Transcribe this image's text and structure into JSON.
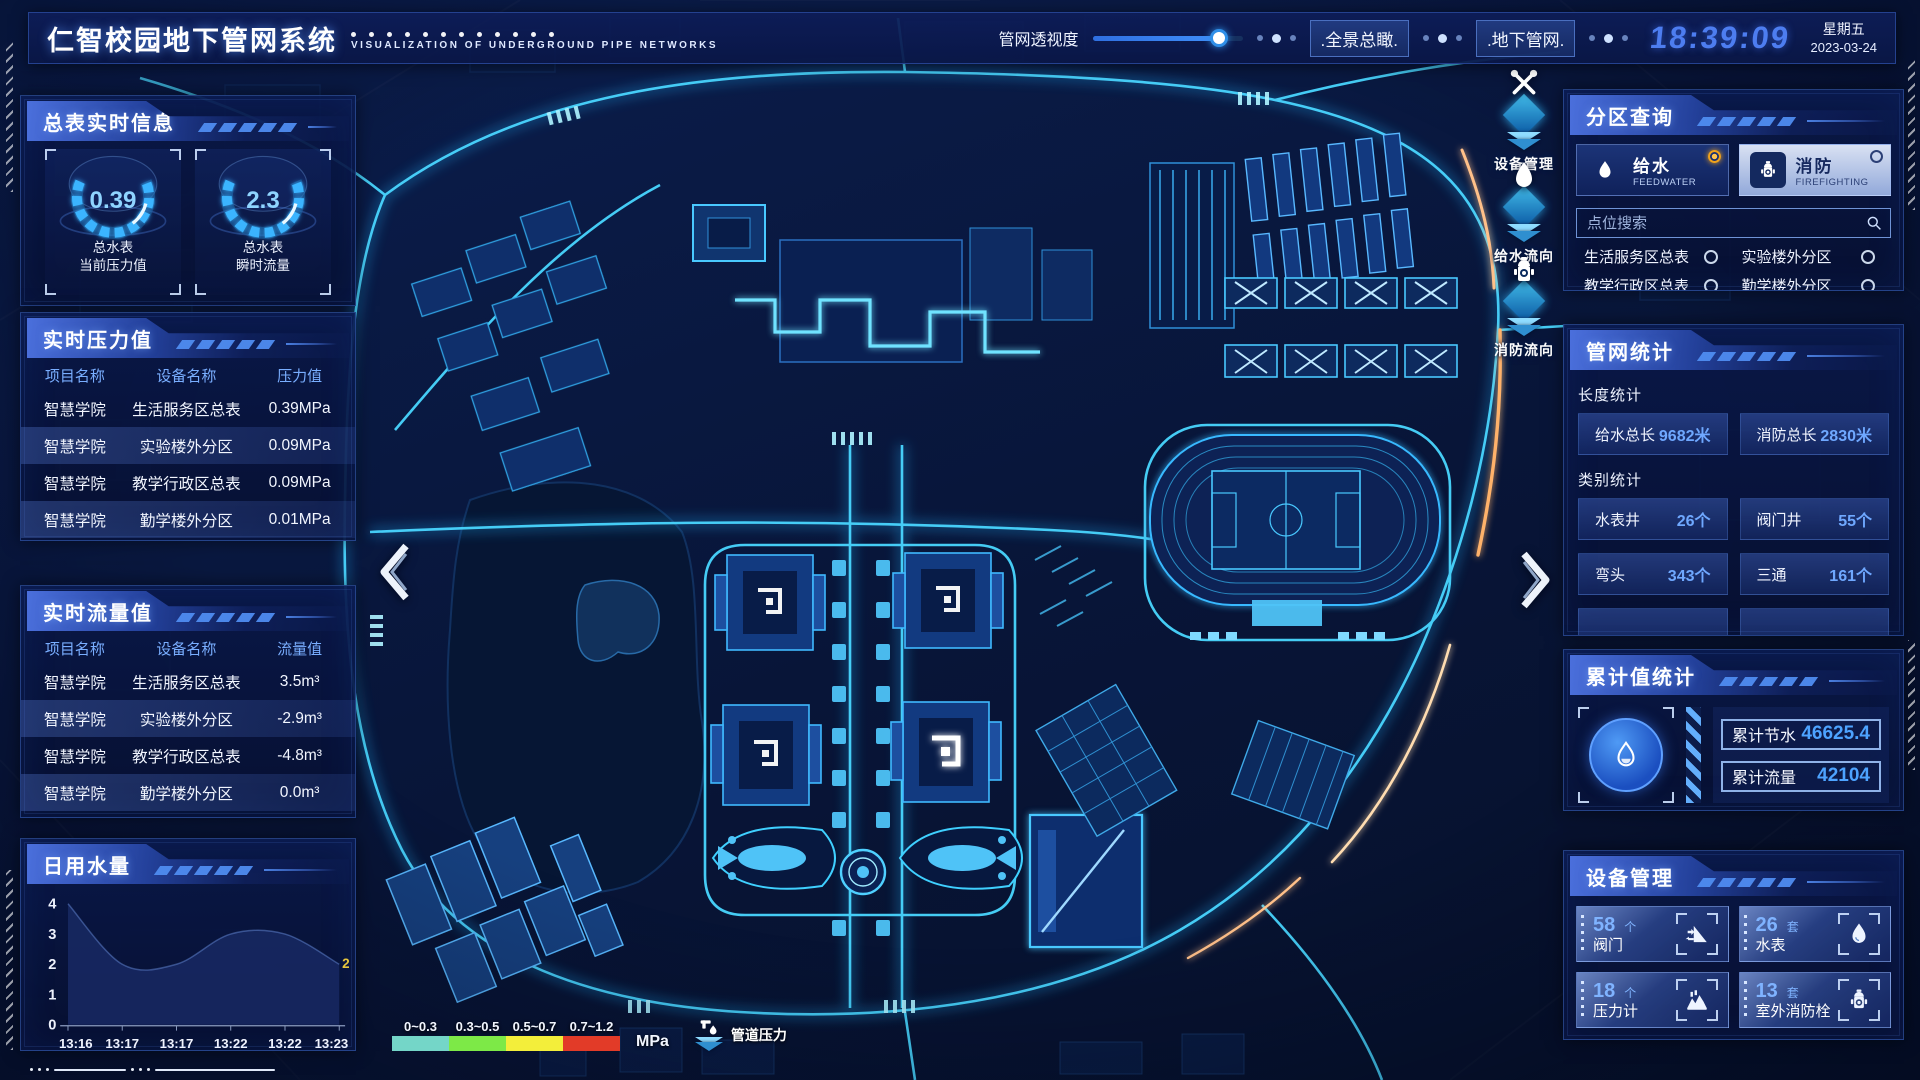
{
  "header": {
    "title": "仁智校园地下管网系统",
    "subtitle": "VISUALIZATION OF UNDERGROUND PIPE NETWORKS",
    "transparency_label": "管网透视度",
    "overview_btn": ".全景总瞰.",
    "underground_btn": ".地下管网.",
    "time": "18:39:09",
    "weekday": "星期五",
    "date": "2023-03-24"
  },
  "left": {
    "meters": {
      "title": "总表实时信息",
      "gauges": [
        {
          "value": "0.39",
          "line1": "总水表",
          "line2": "当前压力值"
        },
        {
          "value": "2.3",
          "line1": "总水表",
          "line2": "瞬时流量"
        }
      ]
    },
    "pressure": {
      "title": "实时压力值",
      "headers": [
        "项目名称",
        "设备名称",
        "压力值"
      ],
      "rows": [
        [
          "智慧学院",
          "生活服务区总表",
          "0.39MPa"
        ],
        [
          "智慧学院",
          "实验楼外分区",
          "0.09MPa"
        ],
        [
          "智慧学院",
          "教学行政区总表",
          "0.09MPa"
        ],
        [
          "智慧学院",
          "勤学楼外分区",
          "0.01MPa"
        ],
        [
          "智慧学院",
          "砺学楼外分区",
          "0.09MPa"
        ]
      ]
    },
    "flow": {
      "title": "实时流量值",
      "headers": [
        "项目名称",
        "设备名称",
        "流量值"
      ],
      "rows": [
        [
          "智慧学院",
          "生活服务区总表",
          "3.5m³"
        ],
        [
          "智慧学院",
          "实验楼外分区",
          "-2.9m³"
        ],
        [
          "智慧学院",
          "教学行政区总表",
          "-4.8m³"
        ],
        [
          "智慧学院",
          "勤学楼外分区",
          "0.0m³"
        ],
        [
          "智慧学院",
          "砺学楼外分区",
          "2.3m³"
        ]
      ]
    },
    "daily": {
      "title": "日用水量"
    }
  },
  "chart_data": {
    "type": "area",
    "title": "日用水量",
    "x": [
      "13:16",
      "13:17",
      "13:17",
      "13:22",
      "13:22",
      "13:23"
    ],
    "values": [
      4,
      2,
      2,
      3,
      3,
      2
    ],
    "ylim": [
      0,
      4
    ],
    "yticks": [
      0,
      1,
      2,
      3,
      4
    ],
    "end_label": "2",
    "area_color": "#16275f",
    "grid": false,
    "legend": "none"
  },
  "map": {
    "tools": [
      {
        "label": "设备管理",
        "icon": "wrench-icon"
      },
      {
        "label": "给水流向",
        "icon": "water-drop-icon"
      },
      {
        "label": "消防流向",
        "icon": "fire-hydrant-icon"
      }
    ],
    "legend": {
      "ranges": [
        "0~0.3",
        "0.3~0.5",
        "0.5~0.7",
        "0.7~1.2"
      ],
      "colors": [
        "#74d6c8",
        "#7de947",
        "#f3ee3a",
        "#e23b28"
      ],
      "unit": "MPa",
      "label": "管道压力"
    }
  },
  "right": {
    "zone": {
      "title": "分区查询",
      "tabs": [
        {
          "name": "给水",
          "en": "FEEDWATER"
        },
        {
          "name": "消防",
          "en": "FIREFIGHTING"
        }
      ],
      "search_placeholder": "点位搜索",
      "items": [
        "生活服务区总表",
        "实验楼外分区",
        "教学行政区总表",
        "勤学楼外分区",
        "砺学楼外分区",
        "宿舍区泵房"
      ]
    },
    "pipe_stats": {
      "title": "管网统计",
      "length_title": "长度统计",
      "length": [
        {
          "label": "给水总长",
          "value": "9682米"
        },
        {
          "label": "消防总长",
          "value": "2830米"
        }
      ],
      "category_title": "类别统计",
      "category": [
        {
          "label": "水表井",
          "value": "26个"
        },
        {
          "label": "阀门井",
          "value": "55个"
        },
        {
          "label": "弯头",
          "value": "343个"
        },
        {
          "label": "三通",
          "value": "161个"
        }
      ]
    },
    "cumulative": {
      "title": "累计值统计",
      "stats": [
        {
          "label": "累计节水",
          "value": "46625.4"
        },
        {
          "label": "累计流量",
          "value": "42104"
        }
      ]
    },
    "devices": {
      "title": "设备管理",
      "cards": [
        {
          "count": "58",
          "unit": "个",
          "label": "阀门",
          "icon": "valve-icon"
        },
        {
          "count": "26",
          "unit": "套",
          "label": "水表",
          "icon": "water-meter-icon"
        },
        {
          "count": "18",
          "unit": "个",
          "label": "压力计",
          "icon": "pressure-gauge-icon"
        },
        {
          "count": "13",
          "unit": "套",
          "label": "室外消防栓",
          "icon": "fire-hydrant-icon"
        }
      ]
    }
  }
}
